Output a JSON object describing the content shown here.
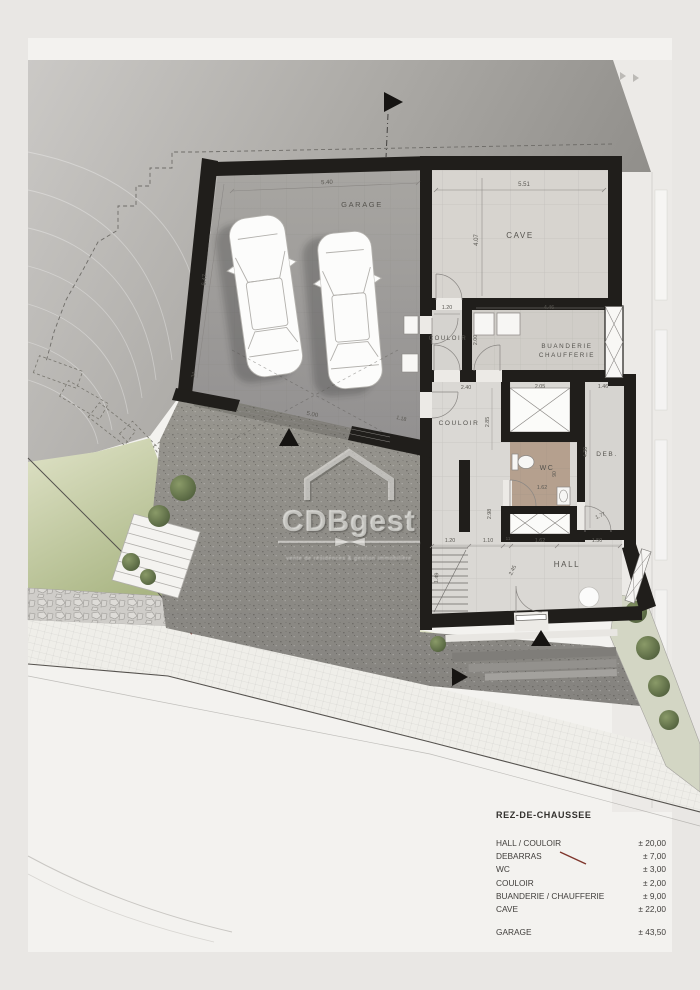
{
  "plan": {
    "rooms": {
      "garage": "GARAGE",
      "cave": "CAVE",
      "couloir1": "COULOIR",
      "buanderie_l1": "BUANDERIE",
      "buanderie_l2": "CHAUFFERIE",
      "couloir2": "COULOIR",
      "wc": "WC",
      "deb": "DEB.",
      "hall": "HALL"
    },
    "dims": {
      "garage_w": "5.40",
      "garage_h": "6.47",
      "garage_wall": "34",
      "garage_door": "5.00",
      "splay": "1.18",
      "cave_w": "5.51",
      "cave_h": "4.07",
      "couloir1_w": "1.20",
      "buanderie_w": "4.46",
      "buanderie_h": "2.00",
      "couloir2_w": "2.40",
      "shaft_w": "2.05",
      "deb_w": "1.46",
      "couloir2_h": "2.85",
      "deb_h": "4.30",
      "wc_w": "1.62",
      "wc_h": "90",
      "hall_left_h": "2.98",
      "deb_door": "1.77",
      "hall_d1": "1.20",
      "hall_d2": "1.10",
      "hall_d3": "11",
      "hall_d4": "1.62",
      "hall_d5": "1.50",
      "stair_w": "1.49",
      "hall_diag": "2.45"
    }
  },
  "watermark": {
    "brand": "CDBgest",
    "tagline": "vente de résidences & gestion immobilière"
  },
  "legend": {
    "title": "REZ-DE-CHAUSSEE",
    "rows": [
      {
        "label": "HALL / COULOIR",
        "value": "± 20,00"
      },
      {
        "label": "DEBARRAS",
        "value": "± 7,00"
      },
      {
        "label": "WC",
        "value": "± 3,00"
      },
      {
        "label": "COULOIR",
        "value": "± 2,00"
      },
      {
        "label": "BUANDERIE / CHAUFFERIE",
        "value": "± 9,00"
      },
      {
        "label": "CAVE",
        "value": "± 22,00"
      }
    ],
    "garage_row": {
      "label": "GARAGE",
      "value": "± 43,50"
    }
  },
  "colors": {
    "wall": "#201e1b",
    "terrain": "#a8a6a3",
    "lawn": "#b9c392",
    "wc_floor": "#b5a08e",
    "boundary_red": "#7e352b",
    "watermark_text": "rgba(236,235,231,0.62)"
  },
  "icons": {
    "north_arrow": "triangle-right",
    "entrance_arrow": "triangle-up",
    "walkway_arrow": "triangle-right",
    "driveway_arrow": "triangle-up",
    "tree": "green-blob",
    "car": "top-view-car"
  }
}
